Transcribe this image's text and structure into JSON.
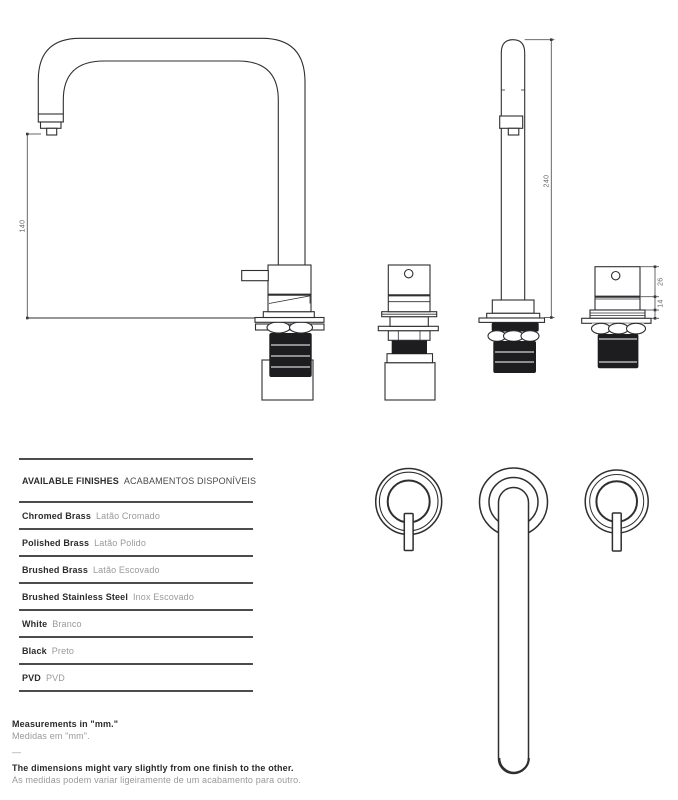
{
  "dimensions": {
    "spout_height": "140",
    "total_height": "240",
    "handle_body_height": "26",
    "handle_neck_height": "14"
  },
  "finishes_table": {
    "title_en": "AVAILABLE FINISHES",
    "title_pt": "ACABAMENTOS DISPONÍVEIS",
    "rows": [
      {
        "en": "Chromed Brass",
        "pt": "Latão Cromado"
      },
      {
        "en": "Polished Brass",
        "pt": "Latão Polido"
      },
      {
        "en": "Brushed Brass",
        "pt": "Latão Escovado"
      },
      {
        "en": "Brushed Stainless Steel",
        "pt": "Inox Escovado"
      },
      {
        "en": "White",
        "pt": "Branco"
      },
      {
        "en": "Black",
        "pt": "Preto"
      },
      {
        "en": "PVD",
        "pt": "PVD"
      }
    ]
  },
  "notes": {
    "measurements_en": "Measurements in \"mm.\"",
    "measurements_pt": "Medidas em \"mm\".",
    "separator": "—",
    "disclaimer_en": "The dimensions might vary slightly from one finish to the other.",
    "disclaimer_pt": "As medidas podem variar ligeiramente de um acabamento para outro."
  },
  "colors": {
    "line": "#2e2f31",
    "dark_fill": "#1d1d1f",
    "text_primary": "#2b2c2e",
    "text_secondary": "#98999b",
    "rule": "#4b4c4e"
  }
}
